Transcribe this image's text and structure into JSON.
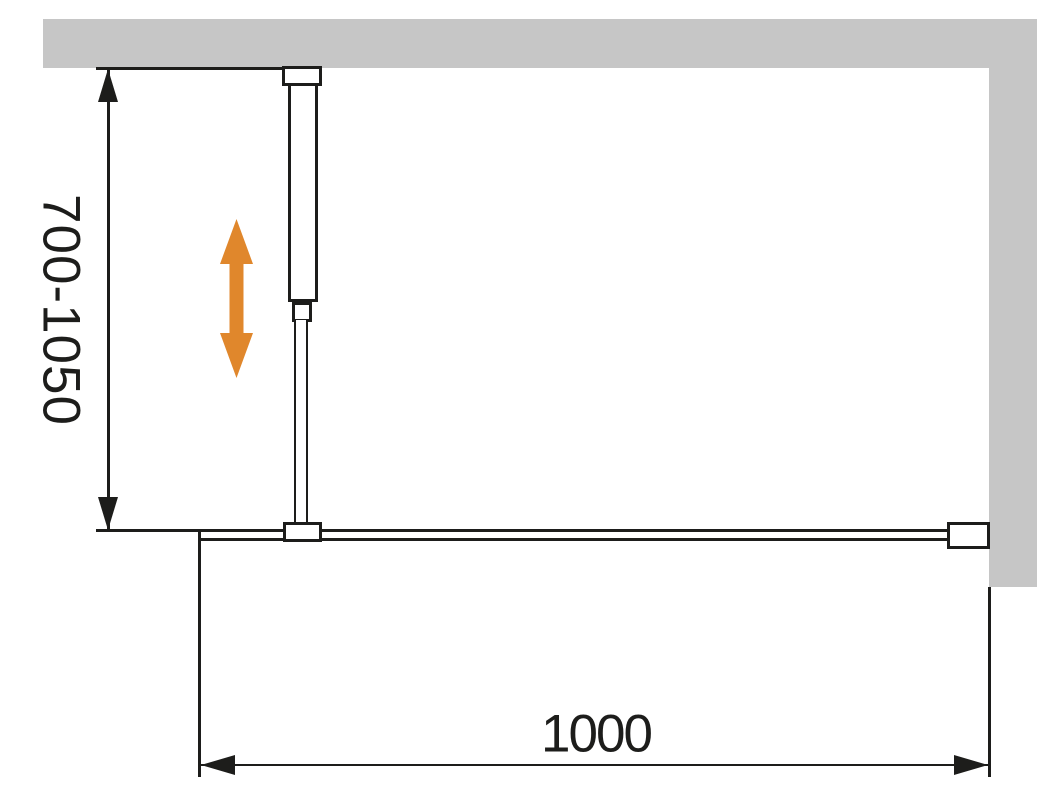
{
  "diagram": {
    "dimensions": {
      "support_bar_range": {
        "label": "700-1050",
        "orientation": "vertical"
      },
      "panel_width": {
        "label": "1000",
        "orientation": "horizontal"
      }
    },
    "colors": {
      "background": "#ffffff",
      "wall_fill": "#c6c6c6",
      "line": "#1d1d1b",
      "accent_arrow": "#e0872c"
    },
    "icons": {
      "adjust_arrow": "double-headed-vertical-arrow"
    }
  }
}
